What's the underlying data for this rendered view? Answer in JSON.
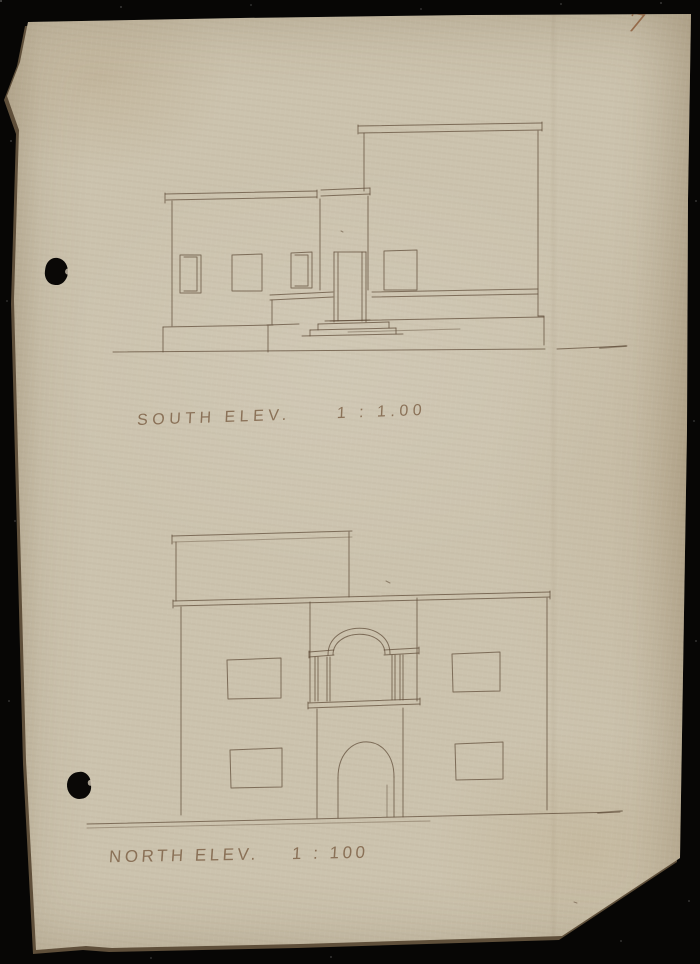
{
  "scan": {
    "page_number": "7",
    "background_color": "#070605",
    "paper_color": "#ccc3ae",
    "ink_color": "#5e4b37",
    "label_color": "#7a5d42"
  },
  "elevations": [
    {
      "id": "south",
      "label": "SOUTH ELEV.",
      "scale": "1 : 1.00"
    },
    {
      "id": "north",
      "label": "NORTH ELEV.",
      "scale": "1 : 100"
    }
  ],
  "sketch": {
    "south": [
      "M113,352 L400,350 L545,349",
      "M557,349 L627,346",
      {
        "d": "M600,348 L626,346",
        "w": 1.8,
        "o": 0.5
      },
      "M165,194 L317,191",
      "M166,200 L317,197",
      "M165,193 L165,203",
      "M317,190 L317,198",
      "M321,190 L370,188",
      "M321,196 L370,194",
      "M370,188 L370,195",
      "M172,201 L172,326",
      "M163,327 L163,352",
      "M163,327 L273,325",
      "M320,199 L320,290",
      "M180,255 L201,255 L201,293 L180,293 Z",
      "M184,257 L197,257 L197,291 L184,291",
      "M232,255 L262,254 L262,291 L232,291 Z",
      "M291,253 L312,252 L312,288 L291,288 Z",
      "M295,255 L308,255 L308,286 L295,286",
      "M334,252 L366,252",
      "M334,252 L334,322",
      "M338,253 L338,321",
      "M362,252 L362,321",
      "M366,252 L366,322",
      "M368,196 L368,290",
      "M270,295 L333,292",
      "M270,300 L333,297",
      "M272,300 L272,324",
      "M267,325 L299,324",
      "M268,326 L268,352",
      "M318,324 L389,322",
      "M318,324 L318,330 M389,322 L389,328",
      "M310,330 L396,328",
      "M310,330 L310,336 M396,328 L396,334",
      "M302,336 L403,334",
      "M325,321 L370,320",
      "M358,126 L542,123",
      "M359,133 L542,130",
      "M358,125 L358,134 M542,122 L542,131",
      "M364,133 L364,191",
      "M538,131 L538,316",
      "M538,316 L544,316 L544,345",
      "M384,251 L417,250 L417,290 L384,290 Z",
      "M372,292 L538,289",
      "M372,297 L538,294",
      "M330,321 L544,317",
      {
        "d": "M348,332 L460,329",
        "o": 0.45
      }
    ],
    "north": [
      "M172,536 L352,531",
      {
        "d": "M173,542 L352,537",
        "o": 0.4
      },
      "M172,535 L172,544",
      "M176,542 L176,601",
      "M349,532 L349,597",
      "M173,601 L550,592",
      "M174,606 L550,597",
      "M173,600 L173,608",
      "M550,591 L550,599",
      "M181,607 L181,815",
      "M547,598 L547,810",
      "M87,824 L620,812",
      {
        "d": "M87,828 L430,821",
        "o": 0.4
      },
      {
        "d": "M598,813 L622,811",
        "w": 1.8,
        "o": 0.5
      },
      "M310,602 L310,702",
      "M417,598 L417,701",
      "M328,655 C328,620 390,619 390,654",
      "M333,655 C333,628 385,627 385,654",
      "M309,652 L334,650 M309,657 L334,655",
      "M384,650 L419,648 M384,655 L419,653",
      "M309,651 L309,658 M419,647 L419,654",
      "M315,657 L315,701 M318,657 L318,701",
      "M327,657 L327,701 M330,657 L330,701",
      "M392,655 L392,700 M395,655 L395,700",
      "M400,655 L400,700 M403,655 L403,700",
      "M308,703 L420,699",
      "M308,708 L420,704",
      "M308,702 L308,709 M420,698 L420,705",
      "M317,709 L317,818",
      "M403,708 L403,817",
      "M338,778 C338,730 394,730 394,777",
      "M338,778 L338,818 M394,777 L394,817",
      {
        "d": "M387,785 L387,817",
        "o": 0.5
      },
      "M227,660 L281,658 L281,698 L228,699 Z",
      "M452,654 L500,652 L500,691 L453,692 Z",
      "M230,750 L282,748 L282,787 L231,788 Z",
      "M455,744 L503,742 L503,779 L456,780 Z"
    ],
    "marks": [
      "M341,231 L343,232",
      "M386,581 L390,583",
      "M574,902 L577,903"
    ]
  }
}
